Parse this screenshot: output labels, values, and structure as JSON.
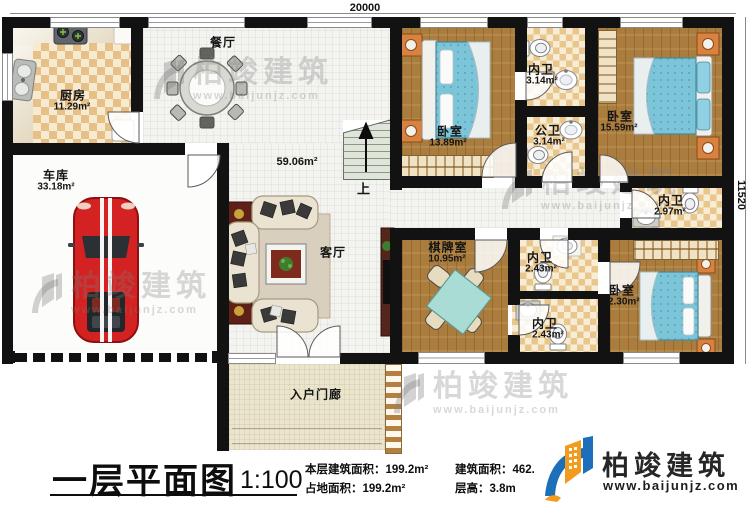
{
  "plan": {
    "dimension_top": "20000",
    "dimension_right": "11520",
    "stairs_up_label": "上"
  },
  "rooms": [
    {
      "id": "kitchen",
      "name": "厨房",
      "area": "11.29m²"
    },
    {
      "id": "dining",
      "name": "餐厅",
      "area": ""
    },
    {
      "id": "garage",
      "name": "车库",
      "area": "33.18m²"
    },
    {
      "id": "living",
      "name": "客厅",
      "area": "59.06m²"
    },
    {
      "id": "entry-porch",
      "name": "入户门廊",
      "area": ""
    },
    {
      "id": "bedroom-1",
      "name": "卧室",
      "area": "13.89m²"
    },
    {
      "id": "ensuite-bath-1",
      "name": "内卫",
      "area": "3.14m²"
    },
    {
      "id": "public-bath",
      "name": "公卫",
      "area": "3.14m²"
    },
    {
      "id": "bedroom-2",
      "name": "卧室",
      "area": "15.59m²"
    },
    {
      "id": "ensuite-bath-2",
      "name": "内卫",
      "area": "2.97m²"
    },
    {
      "id": "chess-room",
      "name": "棋牌室",
      "area": "10.95m²"
    },
    {
      "id": "ensuite-bath-3",
      "name": "内卫",
      "area": "2.43m²"
    },
    {
      "id": "ensuite-bath-4",
      "name": "内卫",
      "area": "2.43m²"
    },
    {
      "id": "bedroom-3",
      "name": "卧室",
      "area": "12.30m²"
    }
  ],
  "title_block": {
    "title": "一层平面图",
    "scale": "1:100",
    "floor_area": "本层建筑面积：199.2m²",
    "footprint_area": "占地面积：199.2m²",
    "gross_area": "建筑面积：462.",
    "floor_height": "层高：3.8m"
  },
  "brand": {
    "name": "柏竣建筑",
    "website": "www.baijunjz.com"
  },
  "watermark": {
    "name": "柏竣建筑",
    "url": "www.baijunjz.com"
  },
  "colors": {
    "wall": "#121212",
    "wood_floor": "#aa7d3e",
    "bath_checker": "#e7c088",
    "tile": "#f3f3ef",
    "bed_blue": "#7cc4d8",
    "car_red": "#d42121",
    "brand_blue": "#1c6fb8",
    "brand_orange": "#f29b1d"
  }
}
